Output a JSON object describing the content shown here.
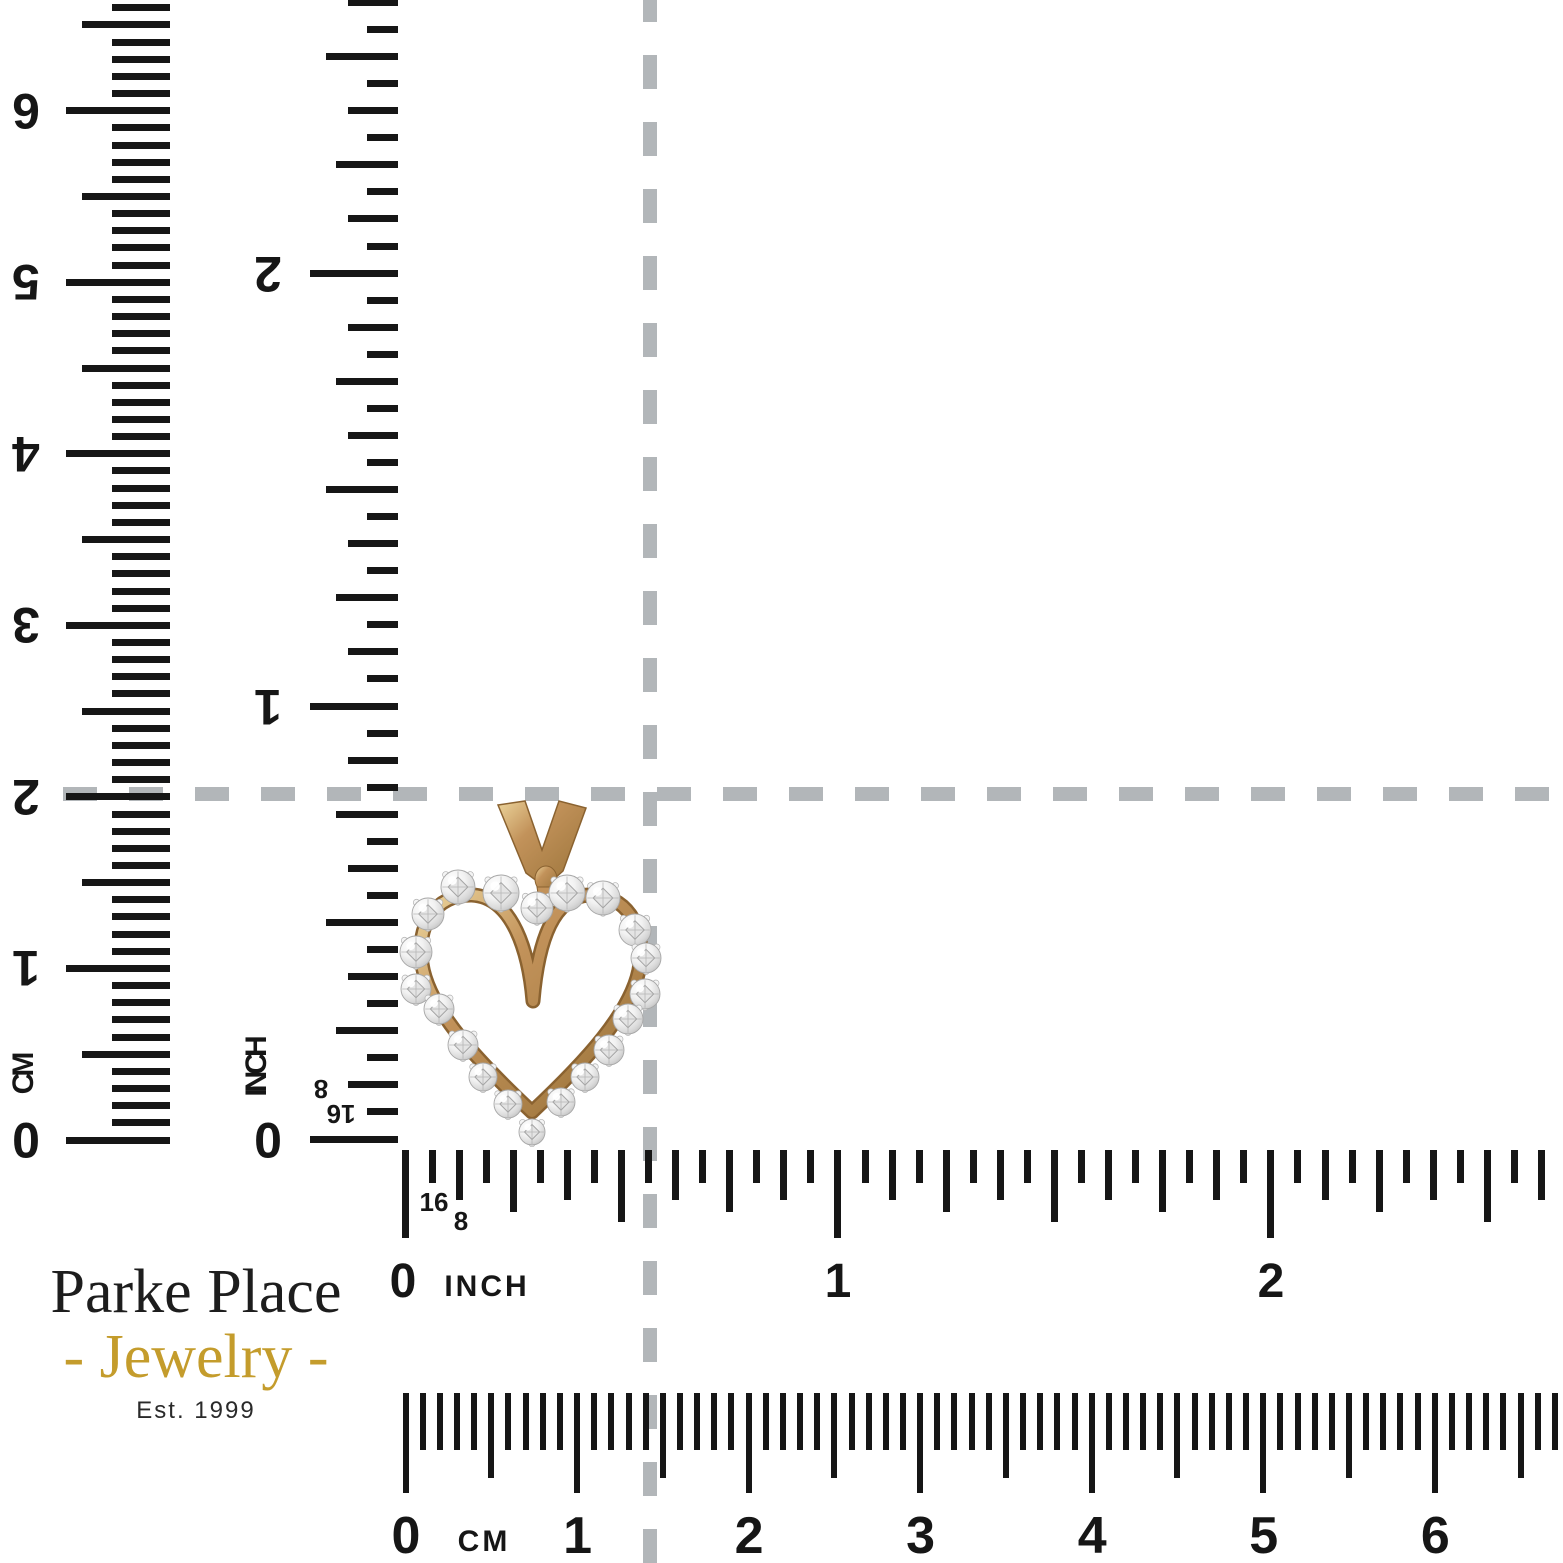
{
  "branding": {
    "name": "Parke Place",
    "product": "- Jewelry -",
    "established": "Est. 1999"
  },
  "rulers": {
    "left_cm": {
      "unit": "CM",
      "numbers": [
        "0",
        "1",
        "2",
        "3",
        "4",
        "5",
        "6"
      ]
    },
    "left_inch": {
      "unit": "INCH",
      "numbers": [
        "0",
        "1",
        "2"
      ],
      "fraction_8": "8",
      "fraction_16": "16"
    },
    "bottom_inch": {
      "unit": "INCH",
      "numbers": [
        "0",
        "1",
        "2"
      ],
      "fraction_16": "16",
      "fraction_8": "8"
    },
    "bottom_cm": {
      "unit": "CM",
      "numbers": [
        "0",
        "1",
        "2",
        "3",
        "4",
        "5",
        "6"
      ]
    }
  },
  "pendant": {
    "kind": "gold-diamond-open-heart-pendant",
    "gold_color": "#c2925a",
    "gold_dark": "#8a6230",
    "gold_light": "#ecd49b",
    "diamond_color": "#ededed",
    "prong_color": "#f4f4f4"
  },
  "colors": {
    "background": "#ffffff",
    "tick": "#161616",
    "dash": "#b2b6b9",
    "logo_text": "#1d1d1d",
    "logo_gold": "#c49c2c"
  }
}
